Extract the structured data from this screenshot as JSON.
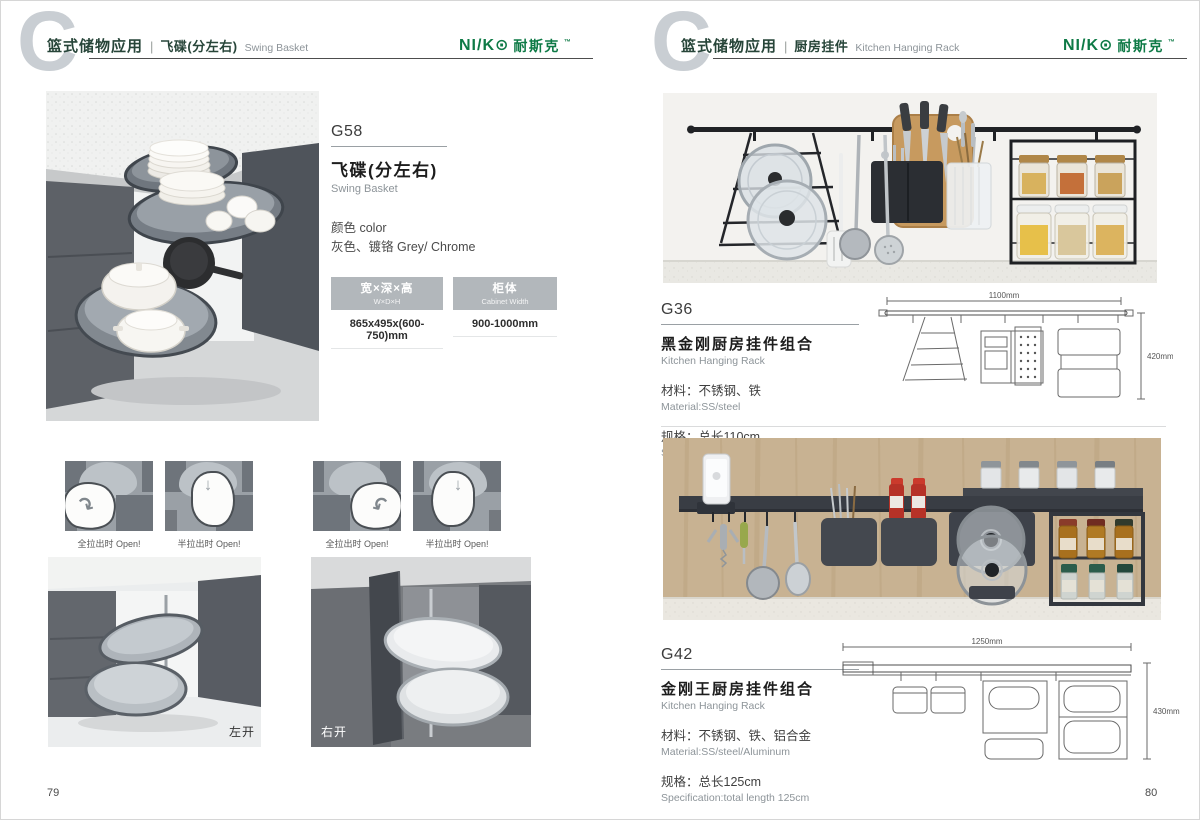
{
  "chapter_letter": "C",
  "brand": {
    "wordmark": "NI/K⊙",
    "wordmark_cn": "耐斯克",
    "mark": "™"
  },
  "colors": {
    "brand_green": "#0e7a46",
    "header_text_green": "#274539",
    "table_header_bg": "#b2b7bb"
  },
  "icons": {
    "swing_arrow": "↷",
    "drop_arrow": "↓"
  },
  "left_page": {
    "header": {
      "category": "篮式储物应用",
      "separator": "|",
      "title_cn": "飞碟(分左右)",
      "title_en": "Swing Basket"
    },
    "product": {
      "code": "G58",
      "name_cn": "飞碟(分左右)",
      "name_en": "Swing Basket",
      "color_label": "颜色 color",
      "color_value": "灰色、镀铬 Grey/ Chrome",
      "table": {
        "columns": [
          {
            "header_cn": "宽×深×高",
            "header_en": "W×D×H",
            "value": "865x495x(600-750)mm"
          },
          {
            "header_cn": "柜体",
            "header_en": "Cabinet Width",
            "value": "900-1000mm"
          }
        ]
      }
    },
    "diagram_captions": [
      "全拉出时 Open!",
      "半拉出时 Open!",
      "全拉出时 Open!",
      "半拉出时 Open!"
    ],
    "photo_captions": {
      "left": "左开",
      "right": "右开"
    },
    "page_number": "79"
  },
  "right_page": {
    "header": {
      "category": "篮式储物应用",
      "separator": "|",
      "title_cn": "厨房挂件",
      "title_en": "Kitchen Hanging Rack"
    },
    "products": [
      {
        "code": "G36",
        "name_cn": "黑金刚厨房挂件组合",
        "name_en": "Kitchen Hanging Rack",
        "material_cn": "材料：不锈钢、铁",
        "material_en": "Material:SS/steel",
        "spec_cn": "规格：总长110cm",
        "spec_en": "Specification:total length 100cm",
        "dim_width": "1100mm",
        "dim_height": "420mm"
      },
      {
        "code": "G42",
        "name_cn": "金刚王厨房挂件组合",
        "name_en": "Kitchen Hanging Rack",
        "material_cn": "材料：不锈钢、铁、铝合金",
        "material_en": "Material:SS/steel/Aluminum",
        "spec_cn": "规格：总长125cm",
        "spec_en": "Specification:total length 125cm",
        "dim_width": "1250mm",
        "dim_height": "430mm"
      }
    ],
    "page_number": "80"
  }
}
